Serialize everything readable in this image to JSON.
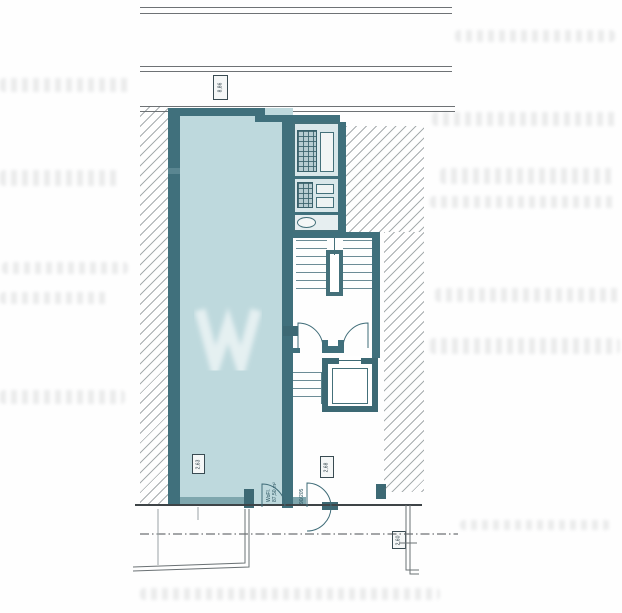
{
  "document": {
    "kind": "scanned architectural floor plan",
    "floor_area_label": "WoFl.",
    "floor_area_value": "87,50 m²",
    "door_size": "90/205"
  },
  "markers": {
    "top_axis": "8,86",
    "living_room_height": "2,63",
    "hall_height": "2,68",
    "boundary": "2,60"
  },
  "colors": {
    "wall_dark": "#40707c",
    "wall_light": "#7fa7ae",
    "room_fill": "#bed9dd",
    "bath_fill": "#d9e7ea",
    "street_line": "#4a4f52",
    "boundary_line": "#6a7174"
  }
}
